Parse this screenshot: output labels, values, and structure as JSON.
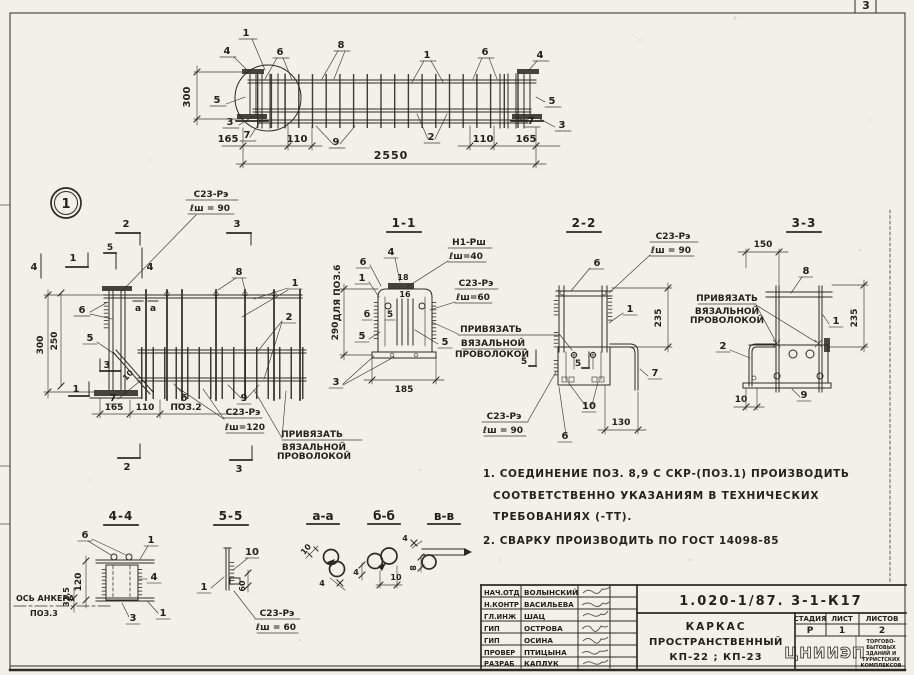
{
  "colors": {
    "paper": "#f2f0e7",
    "ink": "#2c2b23"
  },
  "sheet": {
    "page_number": "3"
  },
  "elevation": {
    "dim_300": "300",
    "dim_165_l": "165",
    "dim_110_l": "110",
    "dim_2550": "2550",
    "dim_110_r": "110",
    "dim_165_r": "165",
    "co_1l": "1",
    "co_4l": "4",
    "co_6l": "6",
    "co_8": "8",
    "co_1r": "1",
    "co_6r": "6",
    "co_4r": "4",
    "co_5l": "5",
    "co_3l": "3",
    "co_7l": "7",
    "co_9": "9",
    "co_2": "2",
    "co_7r": "7",
    "co_3r": "3",
    "co_5r": "5"
  },
  "detail": {
    "bubble": "1",
    "weld_top_1": "С23-Рэ",
    "weld_top_2": "ℓш = 90",
    "weld_bot_1": "С23-Рэ",
    "weld_bot_2": "ℓш=120",
    "tie_1": "ПРИВЯЗАТЬ",
    "tie_2": "ВЯЗАЛЬНОЙ",
    "tie_3": "ПРОВОЛОКОЙ",
    "dim_300": "300",
    "dim_250": "250",
    "dim_165": "165",
    "dim_110": "110",
    "pos2": "ПОЗ.2",
    "mk_2t": "2",
    "mk_3t": "3",
    "mk_1l": "1",
    "mk_4l": "4",
    "mk_4m": "4",
    "mk_5t": "5",
    "mk_3s": "3",
    "mk_1b": "1",
    "mk_2b": "2",
    "mk_3b": "3",
    "co_4": "4",
    "co_6": "6",
    "co_8": "8",
    "co_1": "1",
    "co_2": "2",
    "co_5": "5",
    "co_10": "10",
    "co_7": "7",
    "co_6b": "6",
    "co_9": "9",
    "sec_a1": "а",
    "sec_a2": "а"
  },
  "s11": {
    "title": "1-1",
    "side": "ДЛЯ ПОЗ.6",
    "w1_1": "Н1-Рш",
    "w1_2": "ℓш=40",
    "w2_1": "С23-Рэ",
    "w2_2": "ℓш=60",
    "tie_1": "ПРИВЯЗАТЬ",
    "tie_2": "ВЯЗАЛЬНОЙ",
    "tie_3": "ПРОВОЛОКОЙ",
    "dim_290": "290",
    "dim_185": "185",
    "co_6": "6",
    "co_4": "4",
    "co_1": "1",
    "co_18": "18",
    "co_16": "16",
    "co_b": "б",
    "co_5a": "5",
    "co_5b": "5",
    "co_5c": "5",
    "co_3": "3"
  },
  "s22": {
    "title": "2-2",
    "w_top_1": "С23-Рэ",
    "w_top_2": "ℓш = 90",
    "w_bot_1": "С23-Рэ",
    "w_bot_2": "ℓш = 90",
    "dim_235": "235",
    "dim_130": "130",
    "co_6t": "6",
    "co_1": "1",
    "co_7": "7",
    "co_10": "10",
    "co_6b": "6",
    "mk_5l": "5",
    "mk_5r": "5"
  },
  "s33": {
    "title": "3-3",
    "dim_150": "150",
    "dim_235": "235",
    "dim_10": "10",
    "tie_1": "ПРИВЯЗАТЬ",
    "tie_2": "ВЯЗАЛЬНОЙ",
    "tie_3": "ПРОВОЛОКОЙ",
    "co_8": "8",
    "co_1": "1",
    "co_2": "2",
    "co_9": "9"
  },
  "s44": {
    "title": "4-4",
    "co_6": "6",
    "co_1t": "1",
    "co_4": "4",
    "co_1b": "1",
    "co_3": "3",
    "dim_120": "120",
    "dim_325": "32,5",
    "axis_1": "ОСЬ АНКЕРА",
    "axis_2": "ПОЗ.3"
  },
  "s55": {
    "title": "5-5",
    "co_1": "1",
    "co_10": "10",
    "dim_60": "60",
    "w_1": "С23-Рэ",
    "w_2": "ℓш = 60"
  },
  "saa": {
    "title": "а-а",
    "dim_10": "10",
    "dim_4": "4"
  },
  "sbb": {
    "title": "б-б",
    "dim_4": "4",
    "dim_10": "10"
  },
  "svv": {
    "title": "в-в",
    "dim_4": "4",
    "dim_8": "8"
  },
  "notes": {
    "l1": "1. СОЕДИНЕНИЕ ПОЗ. 8,9 С СКР-(ПОЗ.1) ПРОИЗВОДИТЬ",
    "l2": "СООТВЕТСТВЕННО УКАЗАНИЯМ В ТЕХНИЧЕСКИХ",
    "l3": "ТРЕБОВАНИЯХ (-ТТ).",
    "l4": "2. СВАРКУ ПРОИЗВОДИТЬ ПО ГОСТ 14098-85"
  },
  "titleblock": {
    "doc_number": "1.020-1/87. 3-1-К17",
    "title_1": "КАРКАС",
    "title_2": "ПРОСТРАНСТВЕННЫЙ",
    "title_3": "КП-22 ; КП-23",
    "h_stage": "СТАДИЯ",
    "h_sheet": "ЛИСТ",
    "h_sheets": "ЛИСТОВ",
    "v_stage": "Р",
    "v_sheet": "1",
    "v_sheets": "2",
    "org": "ЦНИИЭП",
    "org_1": "ТОРГОВО-",
    "org_2": "БЫТОВЫХ",
    "org_3": "ЗДАНИЙ И",
    "org_4": "ТУРИСТСКИХ",
    "org_5": "КОМПЛЕКСОВ",
    "staff": [
      {
        "role": "НАЧ.ОТД",
        "name": "ВОЛЫНСКИЙ"
      },
      {
        "role": "Н.КОНТР",
        "name": "ВАСИЛЬЕВА"
      },
      {
        "role": "ГЛ.ИНЖ",
        "name": "ШАЦ"
      },
      {
        "role": "ГИП",
        "name": "ОСТРОВА"
      },
      {
        "role": "ГИП",
        "name": "ОСИНА"
      },
      {
        "role": "ПРОВЕР",
        "name": "ПТИЦЫНА"
      },
      {
        "role": "РАЗРАБ",
        "name": "КАПЛУК"
      }
    ]
  }
}
